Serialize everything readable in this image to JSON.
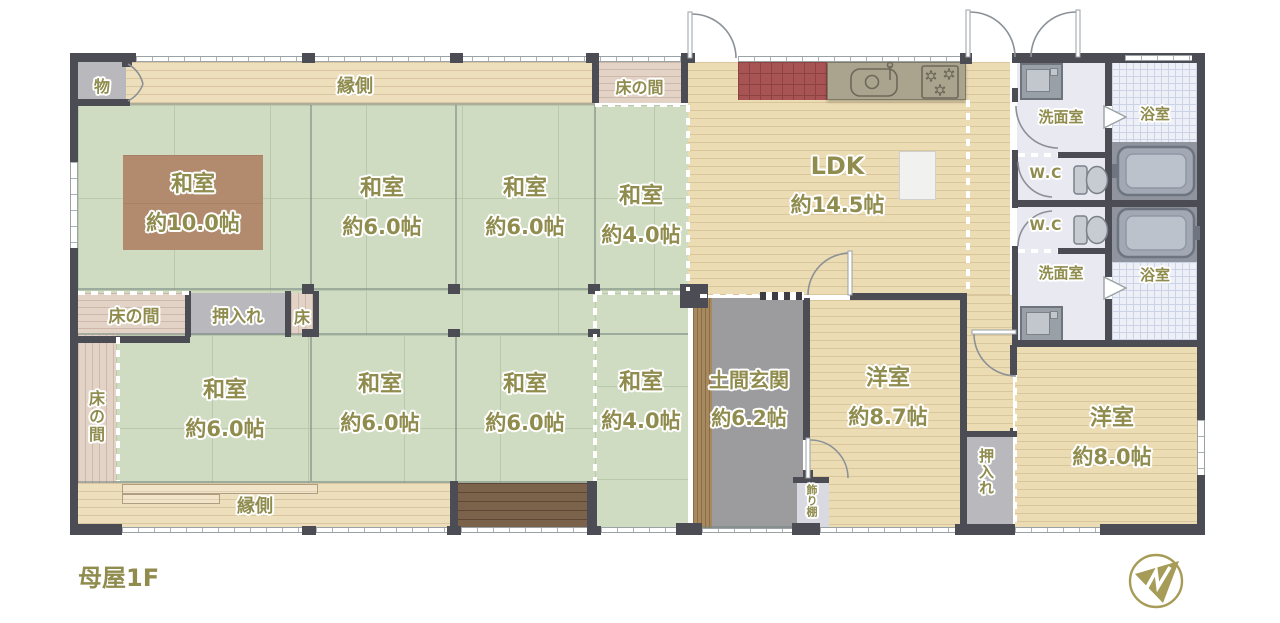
{
  "floor_title": "母屋1F",
  "palette": {
    "wall": "#4c4c54",
    "tatami_green": "#cfdcc1",
    "wood_floor_beige": "#ecdcb4",
    "tokonoma_wood": "#e3d3c6",
    "doma_gray": "#9c9c9f",
    "closet_gray": "#b9b9bd",
    "washroom_floor": "#e9e9f1",
    "bath_tile": "#eef0f7",
    "kitchen_tile_red": "#a85454",
    "dark_deck_wood": "#7b624a",
    "rug_brown": "#b28a6e",
    "label_olive": "#8f8c4e",
    "logo_gold": "#a79b58"
  },
  "rooms": {
    "washitsu10": {
      "name": "和室",
      "area": "約10.0帖"
    },
    "washitsu6a": {
      "name": "和室",
      "area": "約6.0帖"
    },
    "washitsu6b": {
      "name": "和室",
      "area": "約6.0帖"
    },
    "washitsu4a": {
      "name": "和室",
      "area": "約4.0帖"
    },
    "ldk": {
      "name": "LDK",
      "area": "約14.5帖"
    },
    "washitsu6c": {
      "name": "和室",
      "area": "約6.0帖"
    },
    "washitsu6d": {
      "name": "和室",
      "area": "約6.0帖"
    },
    "washitsu6e": {
      "name": "和室",
      "area": "約6.0帖"
    },
    "washitsu4b": {
      "name": "和室",
      "area": "約4.0帖"
    },
    "doma_genkan": {
      "name": "土間玄関",
      "area": "約6.2帖"
    },
    "youshitsu87": {
      "name": "洋室",
      "area": "約8.7帖"
    },
    "youshitsu80": {
      "name": "洋室",
      "area": "約8.0帖"
    }
  },
  "labels": {
    "engawa_top": "縁側",
    "engawa_bottom": "縁側",
    "tokonoma_top": "床の間",
    "tokonoma_mid": "床の間",
    "tokonoma_left": "床の間",
    "tokonoma_small": "床",
    "oshiire_mid": "押入れ",
    "oshiire_right": "押入れ",
    "kazaridana": "飾り棚",
    "storage": "物",
    "senmen_top": "洗面室",
    "senmen_bottom": "洗面室",
    "bath_top": "浴室",
    "bath_bottom": "浴室",
    "wc_top": "W.C",
    "wc_bottom": "W.C"
  },
  "icons": [
    "kitchen-sink-icon",
    "stove-icon",
    "refrigerator-icon",
    "washing-machine-icon",
    "toilet-icon",
    "bathtub-icon",
    "door-swing-icon",
    "folding-door-icon",
    "brand-logo-icon"
  ]
}
